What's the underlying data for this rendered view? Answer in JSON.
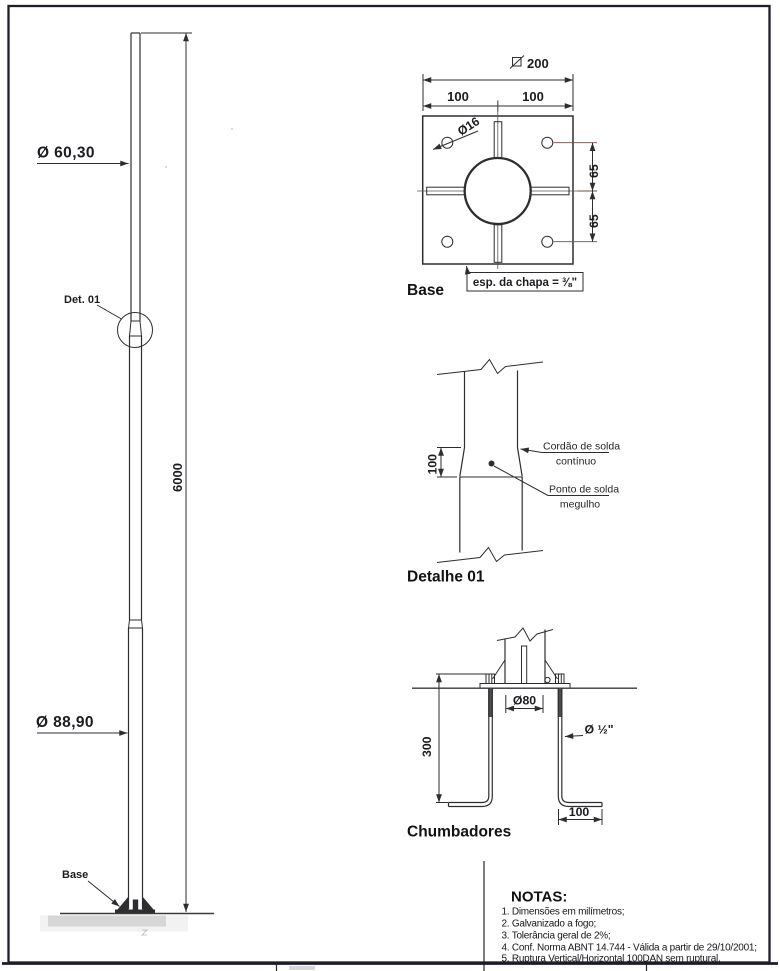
{
  "page": {
    "paper_color": "#ffffff",
    "line_color": "#2e2e31",
    "border_color": "#1d1d2b",
    "accent_line_color": "#6e4f47"
  },
  "pole_view": {
    "top_diameter_label": "Ø 60,30",
    "bottom_diameter_label": "Ø 88,90",
    "height_dim": "6000",
    "detail_callout": "Det. 01",
    "base_callout": "Base"
  },
  "base_view": {
    "title": "Base",
    "overall_dim": "200",
    "half_dim_left": "100",
    "half_dim_right": "100",
    "hole_diameter": "Ø16",
    "offset_upper": "65",
    "offset_lower": "65",
    "thickness_note": "esp. da chapa = ⅜\""
  },
  "detail_view": {
    "title": "Detalhe 01",
    "overlap_dim": "100",
    "continuous_weld_label_line1": "Cordão de solda",
    "continuous_weld_label_line2": "contínuo",
    "plug_weld_label_line1": "Ponto de solda",
    "plug_weld_label_line2": "megulho"
  },
  "anchor_view": {
    "title": "Chumbadores",
    "bolt_circle_dim": "Ø80",
    "bolt_diameter": "Ø ½\"",
    "depth_dim": "300",
    "hook_dim": "100"
  },
  "notes": {
    "heading": "NOTAS:",
    "items": [
      "1. Dimensões em milímetros;",
      "2. Galvanizado a fogo;",
      "3. Tolerância geral de 2%;",
      "4. Conf. Norma ABNT 14.744 - Válida a partir de 29/10/2001;",
      "5. Ruptura Vertical/Horizontal 100DAN sem ruptural."
    ]
  }
}
